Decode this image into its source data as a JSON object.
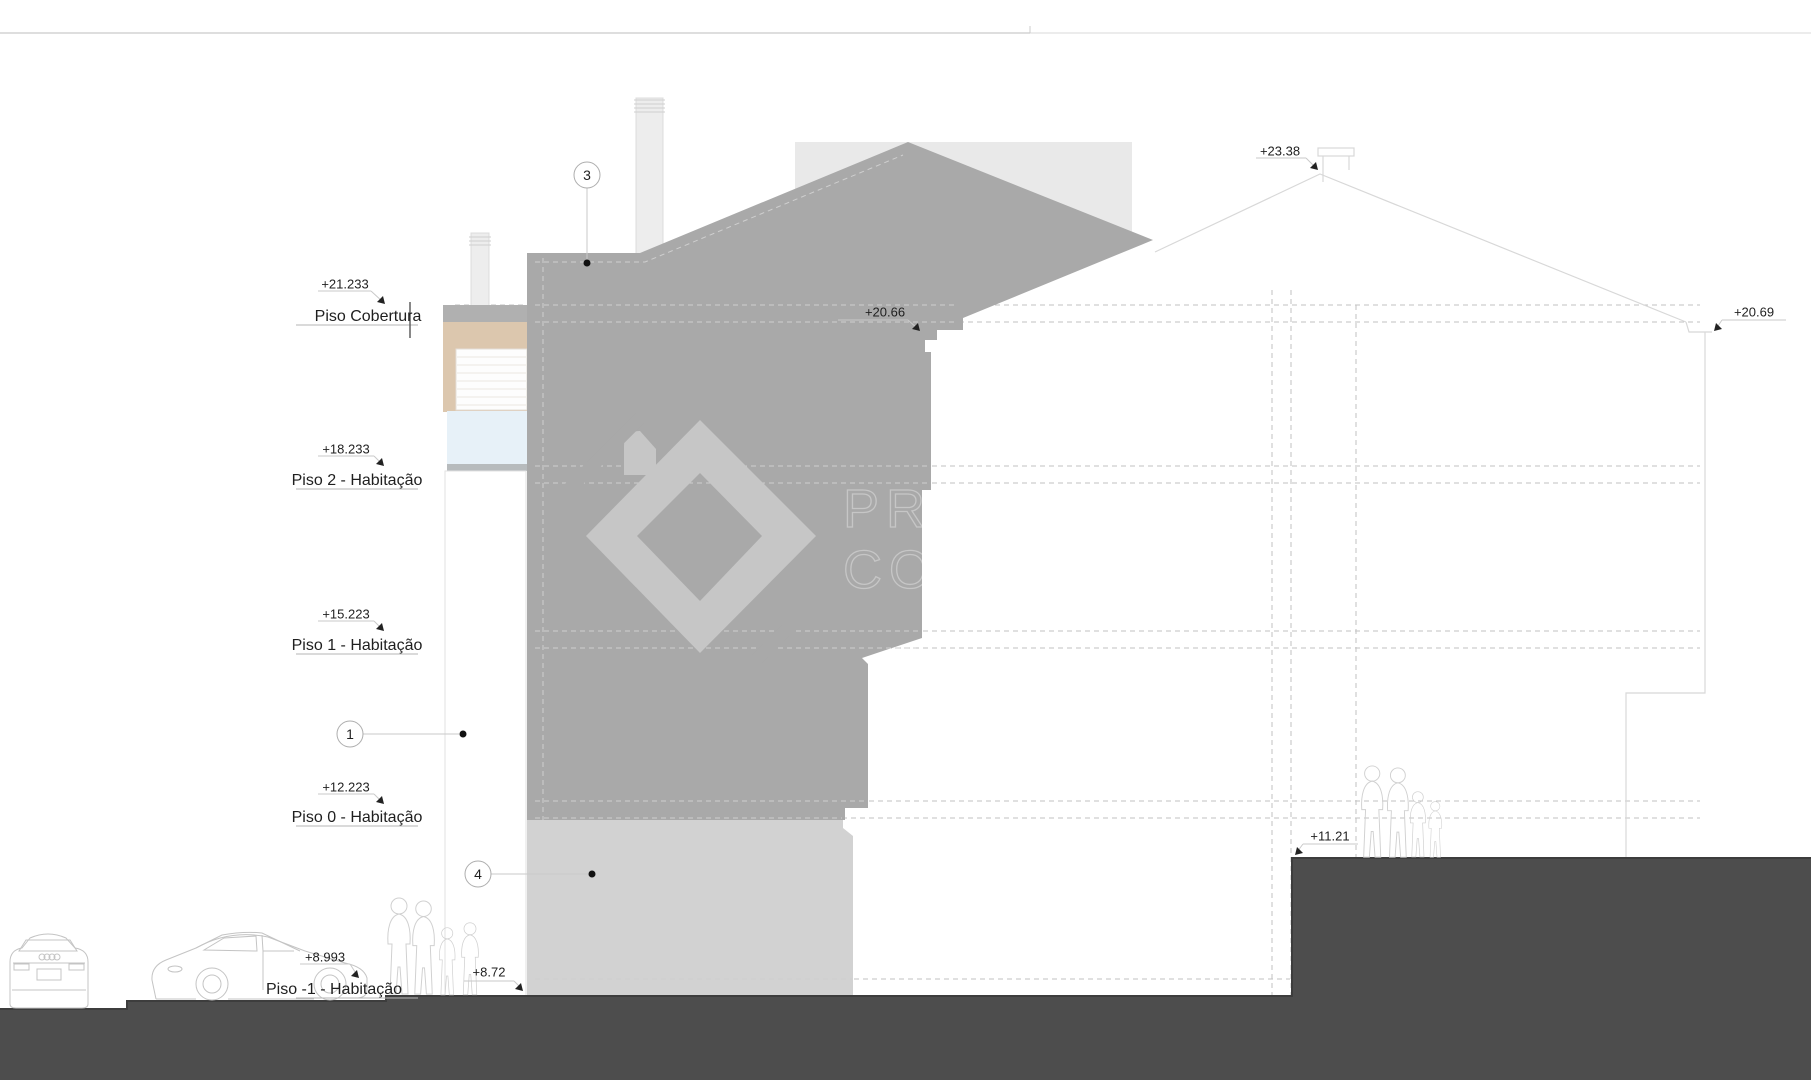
{
  "levels": [
    {
      "elevation": "+21.233",
      "name": "Piso Cobertura"
    },
    {
      "elevation": "+18.233",
      "name": "Piso 2 - Habitação"
    },
    {
      "elevation": "+15.223",
      "name": "Piso 1 - Habitação"
    },
    {
      "elevation": "+12.223",
      "name": "Piso 0 - Habitação"
    },
    {
      "elevation": "+8.993",
      "name": "Piso -1 - Habitação"
    }
  ],
  "spot_elevations": {
    "roof_peak": "+23.38",
    "cornice_left": "+20.66",
    "cornice_right": "+20.69",
    "terrace_right": "+11.21",
    "street_left": "+8.72"
  },
  "callouts": {
    "roof": "3",
    "wall": "1",
    "plinth": "4"
  },
  "watermark": {
    "line1": "PRO",
    "line2": "CO"
  },
  "colors": {
    "mass": "#a9a9a9",
    "base": "#d2d2d2",
    "ground": "#4d4d4d",
    "bg_building": "#e9e9e9",
    "chimney": "#ededed",
    "tan": "#dcc7ae",
    "glass": "#e7f1f8",
    "slab": "#b0b0b0",
    "dash_white": "#cfcfcf",
    "dash_gray": "#c2c2c2",
    "outline": "#d8d8d8",
    "leader": "#c9c9c9",
    "text": "#1f1f1f",
    "watermark": "#c6c6c6"
  }
}
